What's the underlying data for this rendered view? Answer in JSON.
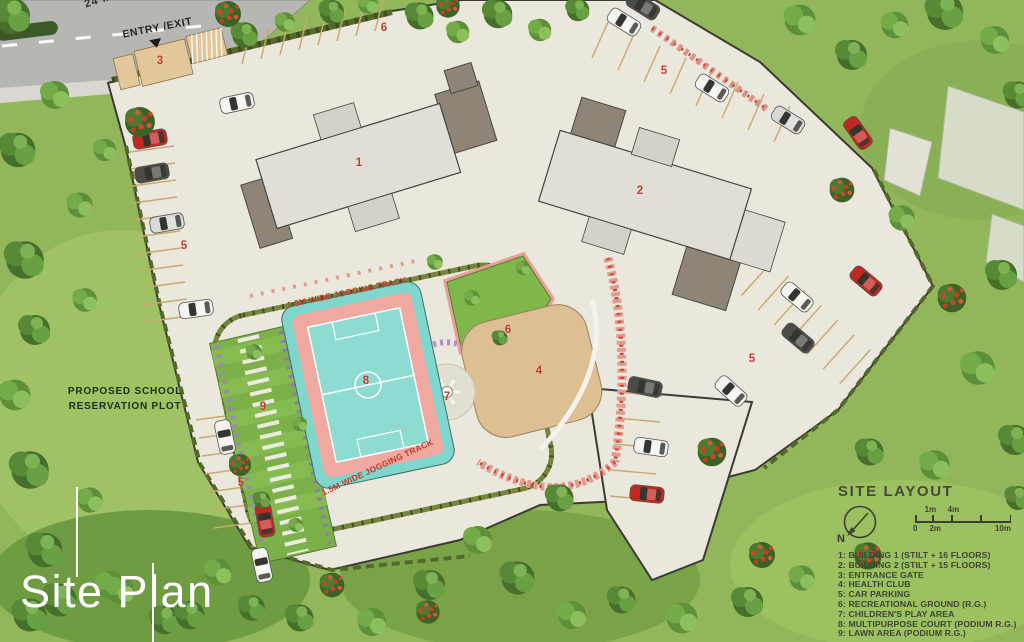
{
  "page": {
    "title": "Site Plan"
  },
  "road": {
    "width_label": "24 M.",
    "entry_exit_label": "ENTRY /EXIT"
  },
  "school_plot": {
    "line1": "PROPOSED SCHOOL",
    "line2": "RESERVATION PLOT"
  },
  "jogging_track": {
    "label_top": "1.5M WIDE JOGGING TRACK",
    "label_bottom": "1.5M WIDE JOGGING TRACK"
  },
  "markers": [
    {
      "label": "3",
      "x": 160,
      "y": 61
    },
    {
      "label": "6",
      "x": 384,
      "y": 28
    },
    {
      "label": "5",
      "x": 664,
      "y": 71
    },
    {
      "label": "1",
      "x": 359,
      "y": 163
    },
    {
      "label": "2",
      "x": 640,
      "y": 191
    },
    {
      "label": "5",
      "x": 184,
      "y": 246
    },
    {
      "label": "5",
      "x": 752,
      "y": 359
    },
    {
      "label": "6",
      "x": 508,
      "y": 330
    },
    {
      "label": "8",
      "x": 366,
      "y": 381
    },
    {
      "label": "4",
      "x": 539,
      "y": 371
    },
    {
      "label": "7",
      "x": 447,
      "y": 397
    },
    {
      "label": "9",
      "x": 263,
      "y": 407
    },
    {
      "label": "5",
      "x": 241,
      "y": 483
    }
  ],
  "legend": {
    "title": "SITE LAYOUT",
    "north_label": "N",
    "scale_bar": {
      "above": [
        "1m",
        "4m"
      ],
      "below": [
        "0",
        "2m",
        "10m"
      ]
    },
    "items": [
      "1: BUILDING 1 (STILT + 16 FLOORS)",
      "2: BUILDING 2 (STILT + 15 FLOORS)",
      "3: ENTRANCE GATE",
      "4: HEALTH CLUB",
      "5: CAR PARKING",
      "6: RECREATIONAL GROUND (R.G.)",
      "7: CHILDREN'S PLAY AREA",
      "8: MULTIPURPOSE COURT (PODIUM R.G.)",
      "9: LAWN AREA (PODIUM R.G.)"
    ]
  },
  "colors": {
    "marker": "#c0392b",
    "grass": "#92b75a",
    "pavement": "#eae7dd",
    "court_teal": "#7fd6cd",
    "court_salmon": "#efa9a0",
    "building": "#e0ded7",
    "building_wing": "#8e8477",
    "legend_text": "#3f4334",
    "title_text": "#ffffff"
  }
}
